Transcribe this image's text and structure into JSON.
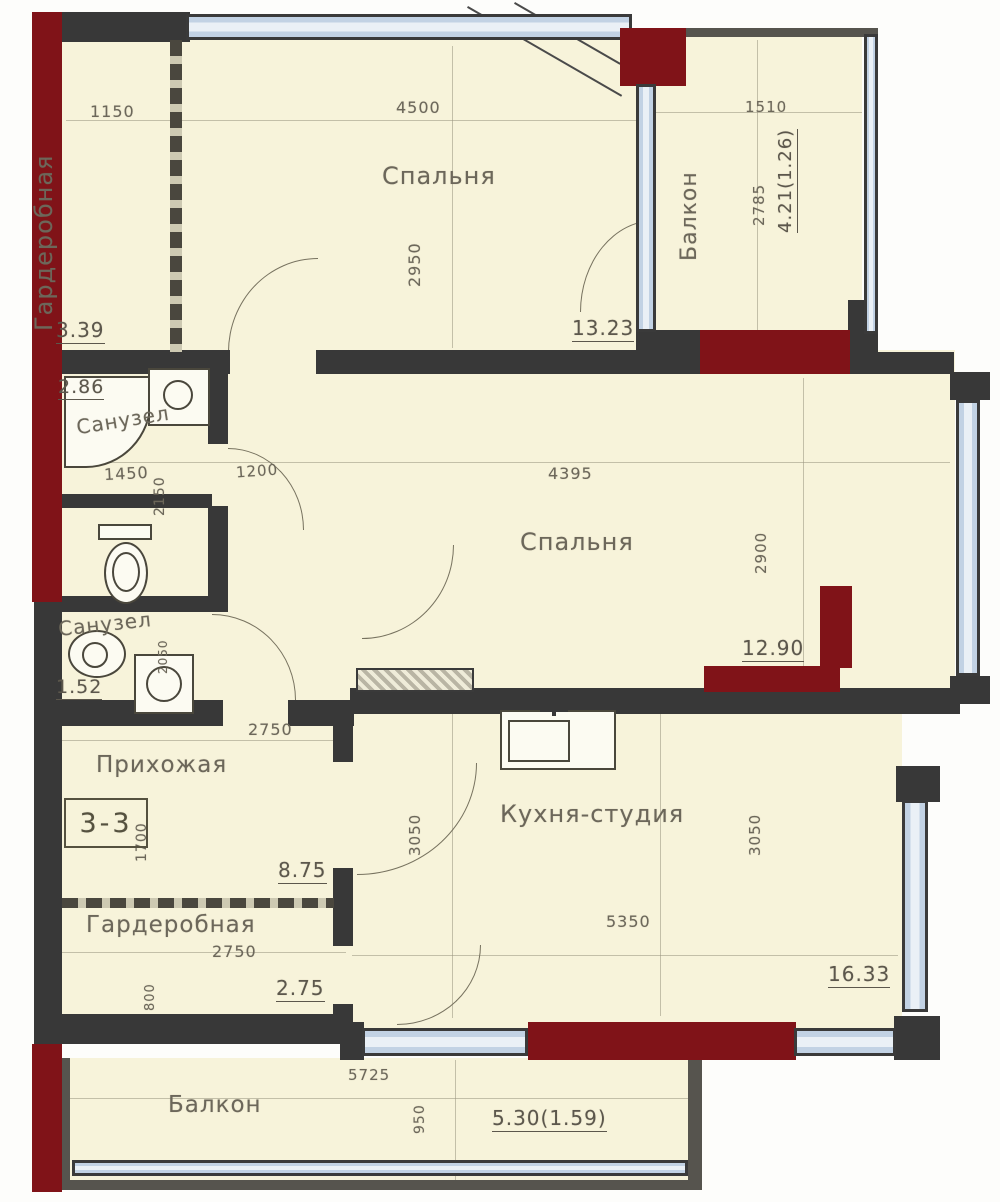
{
  "colors": {
    "cream": "#f7f3da",
    "wall": "#383838",
    "wallmid": "#56544e",
    "red": "#801318",
    "window": "#c2d2e4",
    "windowin": "#eaf0f6",
    "ink": "#6c675a",
    "line": "#99947f"
  },
  "apartment": {
    "unit_label": "3-3",
    "plan_type": "floor-plan"
  },
  "rooms": [
    {
      "name": "Гардеробная",
      "area": "3.39"
    },
    {
      "name": "Спальня",
      "area": "13.23"
    },
    {
      "name": "Балкон",
      "area": "4.21(1.26)"
    },
    {
      "name": "Санузел",
      "area": "2.86"
    },
    {
      "name": "Санузел",
      "area": "1.52"
    },
    {
      "name": "Спальня",
      "area": "12.90"
    },
    {
      "name": "Прихожая",
      "area": "8.75"
    },
    {
      "name": "Гардеробная",
      "area": "2.75"
    },
    {
      "name": "Кухня-студия",
      "area": "16.33"
    },
    {
      "name": "Балкон",
      "area": "5.30(1.59)"
    }
  ],
  "dims": {
    "w1150": "1150",
    "w4500": "4500",
    "h2950": "2950",
    "w1510": "1510",
    "h2785": "2785",
    "w1450": "1450",
    "h2150": "2150",
    "w1200": "1200",
    "w4395": "4395",
    "h2900": "2900",
    "h2050": "2050",
    "w2750": "2750",
    "h1700": "1700",
    "h800": "800",
    "w5350": "5350",
    "h3050": "3050",
    "w5725": "5725",
    "h950": "950"
  }
}
